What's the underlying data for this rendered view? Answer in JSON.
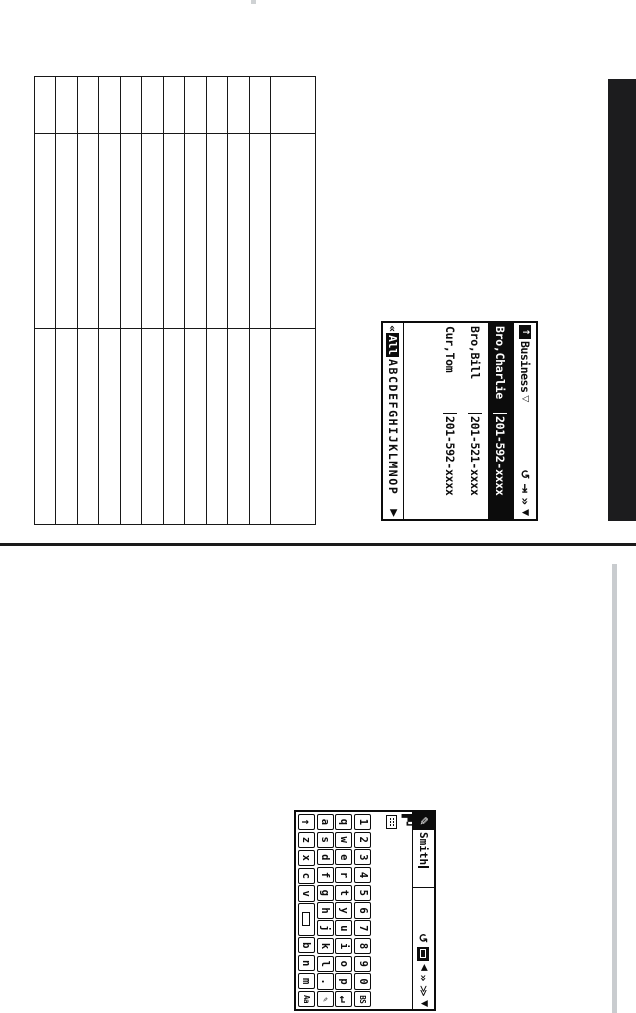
{
  "page": {
    "background": "#ffffff",
    "tab_bar_color": "#1c1c1e",
    "divider_color": "#1a1a1a",
    "gray_rule_color": "#c9cccf"
  },
  "worksheet": {
    "columns": 12,
    "rows": 3
  },
  "phonebook": {
    "folder_label": "Business",
    "dropdown_glyph": "▽",
    "folder_arrow": "↑",
    "toolbar": {
      "return": "↺",
      "tab_next": "⇥",
      "page_forward": "»",
      "scroll_down": "▼"
    },
    "entries": [
      {
        "name": "Bro,Charlie",
        "number": "201-592-xxxx",
        "selected": true
      },
      {
        "name": "Bro,Bill",
        "number": "201-521-xxxx",
        "selected": false
      },
      {
        "name": "Cur,Tom",
        "number": "201-592-xxxx",
        "selected": false
      }
    ],
    "index": {
      "back": "«",
      "all": "All",
      "letters": "ABCDEFGHIJKLMNOP",
      "forward": "▶"
    }
  },
  "keyboard": {
    "pencil_glyph": "✎",
    "field_value": "Smith",
    "mode_blocks": "▛┛",
    "toolbar": {
      "return": "↺",
      "cursor_left": "◀",
      "page_forward": "»",
      "page_forward_outline": "≫",
      "scroll_down": "▼"
    },
    "rows": [
      {
        "keys": [
          {
            "g": "1"
          },
          {
            "g": "2"
          },
          {
            "g": "3"
          },
          {
            "g": "4"
          },
          {
            "g": "5"
          },
          {
            "g": "6"
          },
          {
            "g": "7"
          },
          {
            "g": "8"
          },
          {
            "g": "9"
          },
          {
            "g": "0"
          },
          {
            "g": "BS",
            "small": true,
            "id": "backspace"
          }
        ]
      },
      {
        "keys": [
          {
            "g": "q"
          },
          {
            "g": "w"
          },
          {
            "g": "e"
          },
          {
            "g": "r"
          },
          {
            "g": "t"
          },
          {
            "g": "y"
          },
          {
            "g": "u"
          },
          {
            "g": "i"
          },
          {
            "g": "o"
          },
          {
            "g": "p"
          },
          {
            "g": "↵",
            "bold": true,
            "id": "enter"
          }
        ]
      },
      {
        "keys": [
          {
            "g": "a"
          },
          {
            "g": "s"
          },
          {
            "g": "d"
          },
          {
            "g": "f"
          },
          {
            "g": "g"
          },
          {
            "g": "h"
          },
          {
            "g": "j"
          },
          {
            "g": "k"
          },
          {
            "g": "l"
          },
          {
            "g": "."
          },
          {
            "g": "✎",
            "small": true,
            "id": "symbols"
          }
        ]
      },
      {
        "keys": [
          {
            "g": "↑",
            "bold": true,
            "id": "shift"
          },
          {
            "g": "z"
          },
          {
            "g": "x"
          },
          {
            "g": "c"
          },
          {
            "g": "v"
          },
          {
            "g": "",
            "shape": "rect",
            "wide": true,
            "id": "space"
          },
          {
            "g": "b"
          },
          {
            "g": "n"
          },
          {
            "g": "m"
          },
          {
            "g": "Aa",
            "small": true,
            "id": "case"
          }
        ]
      }
    ]
  }
}
